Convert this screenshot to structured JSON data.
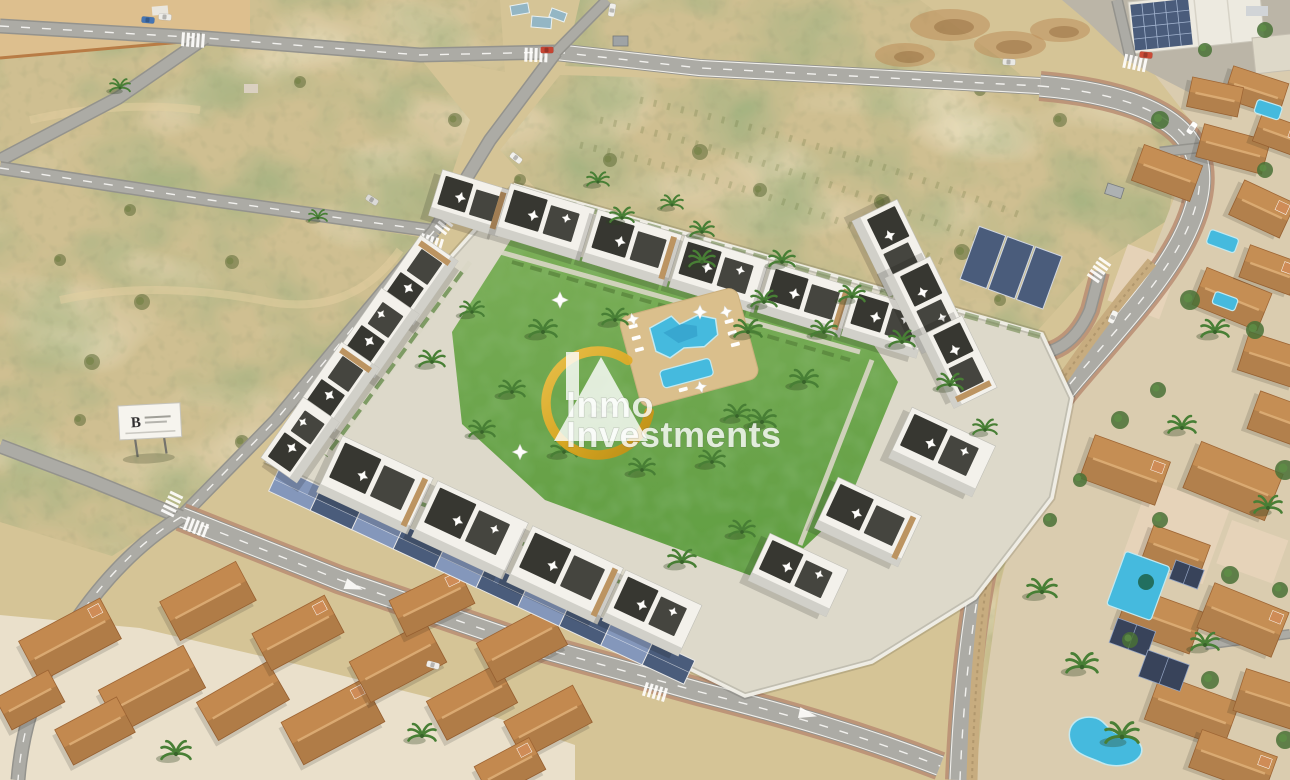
{
  "scene": {
    "description": "Sunny aerial photograph of a new-build residential complex with communal pool, lawn courtyard and solar carports, surrounded by empty scrubland plots, roads and an established villa neighbourhood",
    "watermark": {
      "line1": "Inmo",
      "line2": "Investments"
    },
    "billboard": {
      "monogram": "B"
    },
    "colors": {
      "sand": "#d3c294",
      "sandLight": "#e8d8ab",
      "scrub": "#5f7038",
      "scrubLight": "#7d8a4e",
      "road": "#a8a8a4",
      "roadCasing": "#8f8f8b",
      "roadLine": "#ffffff",
      "sidewalk": "#b5886f",
      "lawn": "#63a344",
      "lawnDark": "#47892e",
      "deck": "#d9bd8a",
      "pool": "#3cb8e0",
      "poolDeep": "#1f90c2",
      "building": "#f3f2ee",
      "buildingShade": "#cfcfca",
      "roofDark": "#22231f",
      "stoneAccent": "#b9905c",
      "solar": "#415578",
      "solarLight": "#7e93bb",
      "terracotta": "#c08449",
      "terracottaDark": "#995d2c",
      "wall": "#f1f0ea",
      "stoneWall": "#c4a97c",
      "villaBase": "#d9cbae",
      "treeGreen": "#3f6b2f",
      "gold": "#dfa61f"
    }
  }
}
